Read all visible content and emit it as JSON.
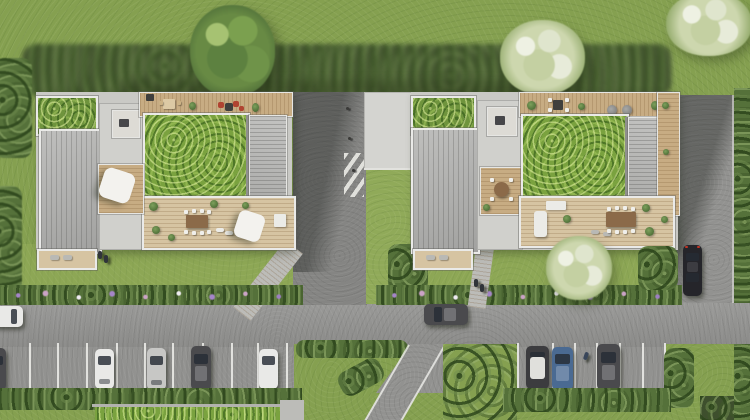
{
  "scene": {
    "type": "aerial architectural rendering",
    "view": "top-down site plan, photorealistic",
    "subject": "two residential buildings with extensive green roofs and rooftop terraces, lawns with trees, central pedestrian driveway with crosswalk, perimeter roads and parking lots with cars"
  },
  "palette": {
    "grass_base": "#85a050",
    "grass_sunny": "#90aa59",
    "vegetation_shadow": "#3e4f2d",
    "hedge": "#55713a",
    "green_roof": "#7aa23f",
    "green_roof_small": "#6f943d",
    "asphalt": "#929290",
    "asphalt_driveway": "#858583",
    "asphalt_shadow": "#6e6e6c",
    "concrete_plaza": "#d4d4d0",
    "concrete_core": "#d0d0cc",
    "concrete_slab": "#c9c9c5",
    "paver_path": "#bcbcb8",
    "metal_roof": "#b4b4b2",
    "metal_panel": "#bcbcba",
    "deck_wood": "#c7ac83",
    "deck_wood_light": "#d6c4a2",
    "frame_white": "#eaeae8",
    "stall_line": "#eeeeea",
    "umbrella_white": "#f3f2ee",
    "furniture_red": "#b04331",
    "furniture_dark": "#3f3f3d",
    "table_brown": "#8b6a49",
    "counter_white": "#ebebe7",
    "skylight_dark": "#47474a",
    "car_white": "#e9e9e7",
    "car_silver": "#c7c7c5",
    "car_dark_gray": "#4a4a4d",
    "car_black": "#25252a",
    "car_blue": "#4a6a92",
    "car_body_whiteroof": "#3c3c3f",
    "car_roof_white": "#e0e0dc",
    "taillight_red": "#c23424",
    "person": "#30343a",
    "tree_green": "#688a44",
    "tree_blossom": "#cdd7ae",
    "flower_purple": "#9d7fc2",
    "flower_pink": "#cba3c6",
    "flower_white": "#eeebf1"
  },
  "buildings": {
    "left": {
      "label": "west building",
      "roof_features": [
        "small green roof patch (north-west)",
        "standing-seam metal roof (west wing)",
        "stair core with dark skylight",
        "north roof deck with wooden dining set and red lounge chairs",
        "large extensive green roof",
        "ribbed metal panel (east)",
        "south rooftop terrace with dining table, white chairs, sun loungers and white parasol",
        "west patio with white parasol",
        "ground-floor south deck with loungers"
      ]
    },
    "right": {
      "label": "east building",
      "roof_features": [
        "small green roof patch (north-west)",
        "standing-seam metal roof (west wing)",
        "stair core with dark skylight",
        "north roof deck with dark table, white chairs and two round lounge chairs",
        "large extensive green roof",
        "ribbed metal panel (east)",
        "south rooftop terrace with dining table, white chairs, white spa loungers and counter",
        "inner courtyard deck with round table and four chairs",
        "east balcony deck with plants",
        "ground-floor south deck with loungers"
      ]
    }
  },
  "vehicles": {
    "moving_on_road": [
      {
        "id": "white car entering at west edge",
        "color_ref": "car_white"
      },
      {
        "id": "dark car at center of road",
        "color_ref": "car_dark_gray"
      }
    ],
    "parked_left_lot": [
      {
        "id": "partial dark car at edge",
        "color_ref": "car_dark_gray"
      },
      {
        "id": "white car",
        "color_ref": "car_white"
      },
      {
        "id": "silver car",
        "color_ref": "car_silver"
      },
      {
        "id": "dark gray car",
        "color_ref": "car_dark_gray"
      },
      {
        "id": "white car",
        "color_ref": "car_white"
      }
    ],
    "parked_middle_lot": [
      {
        "id": "dark car with white roof",
        "color_ref": "car_body_whiteroof"
      },
      {
        "id": "blue car",
        "color_ref": "car_blue"
      },
      {
        "id": "dark gray car",
        "color_ref": "car_dark_gray"
      }
    ],
    "parked_right_road": [
      {
        "id": "black car on north-south road",
        "color_ref": "car_black"
      }
    ]
  },
  "people": [
    "two residents on left building south deck",
    "two pedestrians on right footpath",
    "one pedestrian in middle parking lot"
  ],
  "landscape": [
    "large deciduous tree top-left",
    "white blossom tree top-center",
    "white blossom tree top-right corner",
    "white blossom tree at right building south lawn",
    "tree shadow band across upper lawn",
    "flower beds with purple, pink and white blooms along the road",
    "hedge rows below both parking lots",
    "triangular grass island with shrubs between parking areas",
    "diagonal access road at bottom center",
    "pedestrian crosswalk with white diagonal stripes on central driveway"
  ]
}
